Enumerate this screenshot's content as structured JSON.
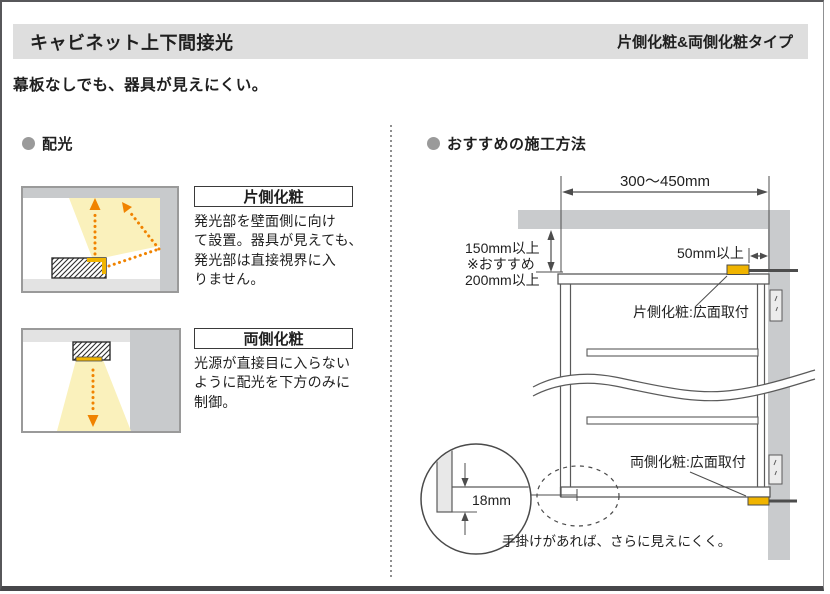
{
  "header": {
    "title": "キャビネット上下間接光",
    "type_label": "片側化粧&両側化粧タイプ"
  },
  "subtitle": "幕板なしでも、器具が見えにくい。",
  "distribution": {
    "section_title": "配光",
    "one_side": {
      "label": "片側化粧",
      "desc": "発光部を壁面側に向け\nて設置。器具が見えても、\n発光部は直接視界に入\nりません。"
    },
    "both_sides": {
      "label": "両側化粧",
      "desc": "光源が直接目に入らない\nように配光を下方のみに\n制御。"
    }
  },
  "installation": {
    "section_title": "おすすめの施工方法",
    "dim_top_width": "300〜450mm",
    "dim_clearance": "150mm以上",
    "dim_clearance_note_prefix": "※おすすめ",
    "dim_clearance_note_value": "200mm以上",
    "dim_side_gap": "50mm以上",
    "label_top_fixture": "片側化粧:広面取付",
    "label_bottom_fixture": "両側化粧:広面取付",
    "dim_detail": "18mm",
    "note": "手掛けがあれば、さらに見えにくく。"
  },
  "colors": {
    "fixture_yellow": "#F0B400",
    "light_cone_yellow": "#FAF1BC",
    "arrow_orange": "#F08300",
    "wall_gray": "#C8CACC",
    "header_bar_gray": "#DEDEDE"
  }
}
